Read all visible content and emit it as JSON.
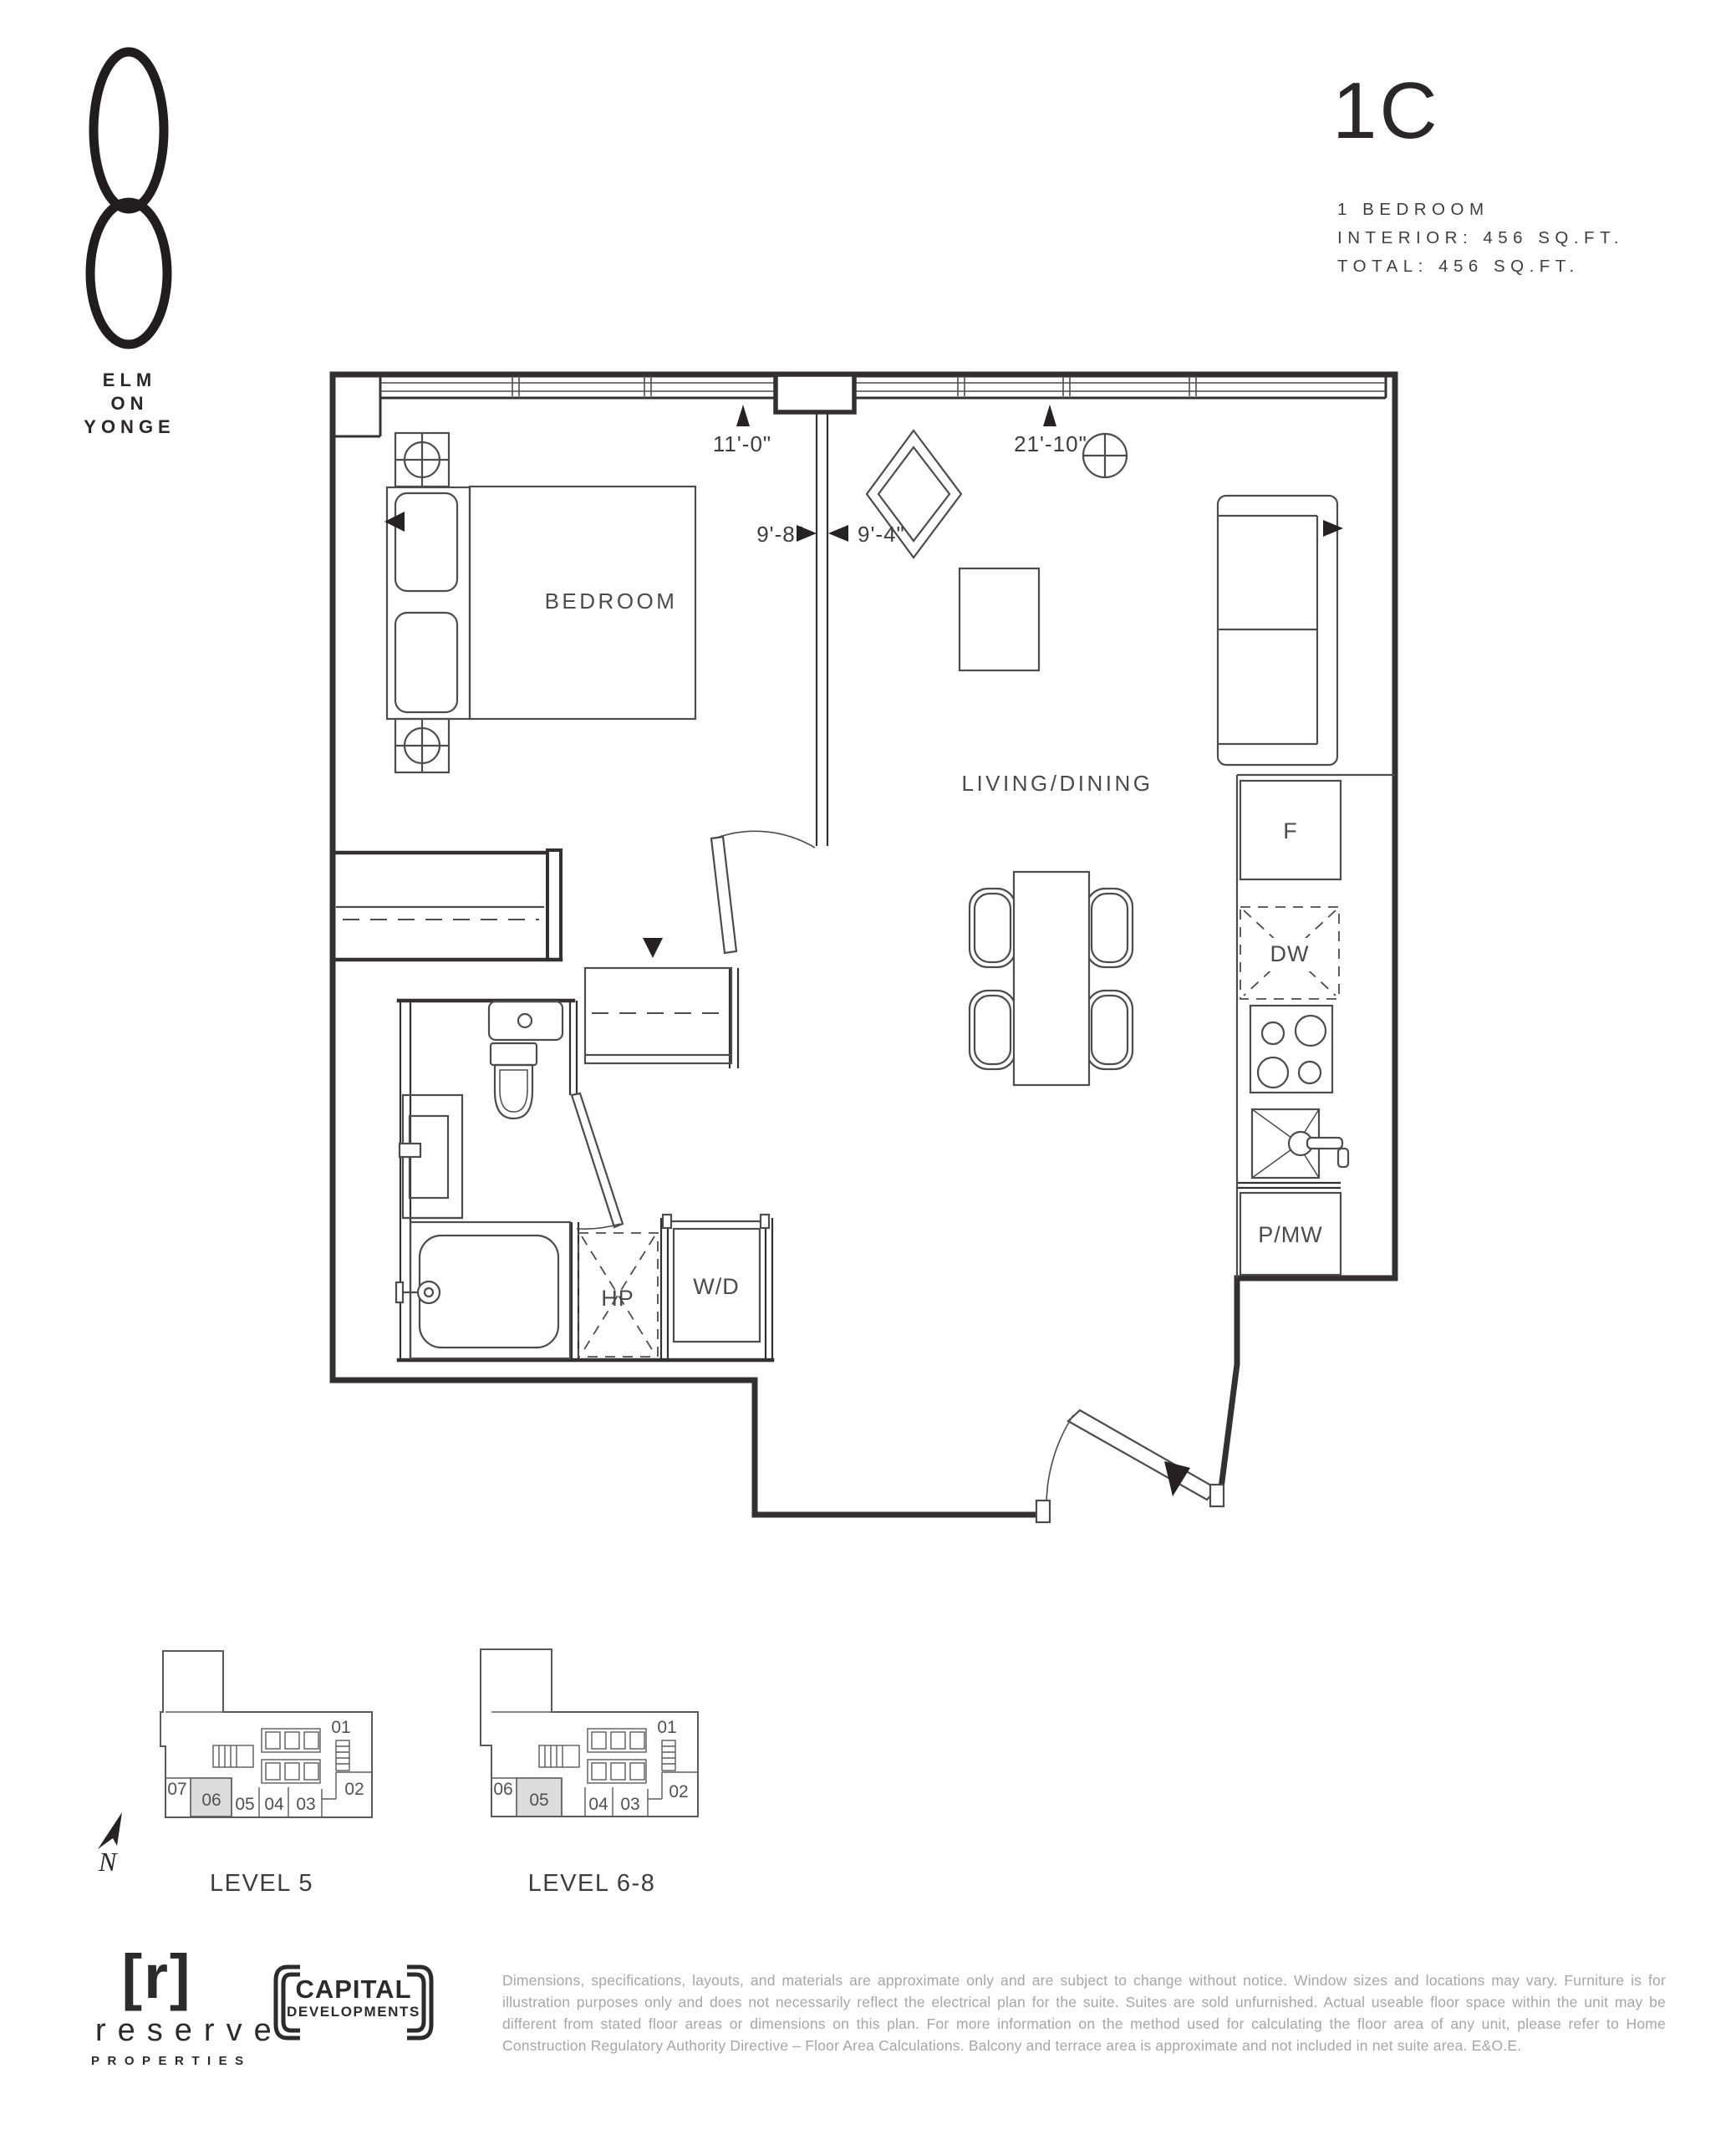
{
  "brand": {
    "logo": "8-mark",
    "line1": "ELM",
    "line2": "ON",
    "line3": "YONGE"
  },
  "unit": {
    "code": "1C",
    "type": "1 BEDROOM",
    "interior": "INTERIOR: 456 SQ.FT.",
    "total": "TOTAL: 456 SQ.FT."
  },
  "plan": {
    "rooms": {
      "bedroom": "BEDROOM",
      "living_dining": "LIVING/DINING"
    },
    "labels": {
      "fridge": "F",
      "dishwasher": "DW",
      "heat_pump": "HP",
      "washer_dryer": "W/D",
      "pantry_microwave": "P/MW"
    },
    "dimensions": {
      "top_left": "11'-0\"",
      "top_right": "21'-10\"",
      "mid_left": "9'-8\"",
      "mid_right": "9'-4\""
    }
  },
  "keyplans": [
    {
      "title": "LEVEL 5",
      "highlighted_unit": "06",
      "unit_labels": {
        "u01": "01",
        "u02": "02",
        "u03": "03",
        "u04": "04",
        "u05": "05",
        "u06": "06",
        "u07": "07"
      }
    },
    {
      "title": "LEVEL 6-8",
      "highlighted_unit": "05",
      "unit_labels": {
        "u01": "01",
        "u02": "02",
        "u03": "03",
        "u04": "04",
        "u05": "05",
        "u06": "06"
      }
    }
  ],
  "compass": {
    "north": "N"
  },
  "footer": {
    "reserve": {
      "mark": "[r]",
      "name": "reserve",
      "tagline": "PROPERTIES"
    },
    "capital": {
      "line1": "CAPITAL",
      "line2": "DEVELOPMENTS"
    },
    "disclaimer": "Dimensions, specifications, layouts, and materials are approximate only and are subject to change without notice. Window sizes and locations may vary. Furniture is for illustration purposes only and does not necessarily reflect the electrical plan for the suite. Suites are sold unfurnished. Actual useable floor space within the unit may be different from stated floor areas or dimensions on this plan. For more information on the method used for calculating the floor area of any unit, please refer to Home Construction Regulatory Authority Directive – Floor Area Calculations. Balcony and terrace area is approximate and not included in net suite area. E&O.E."
  }
}
